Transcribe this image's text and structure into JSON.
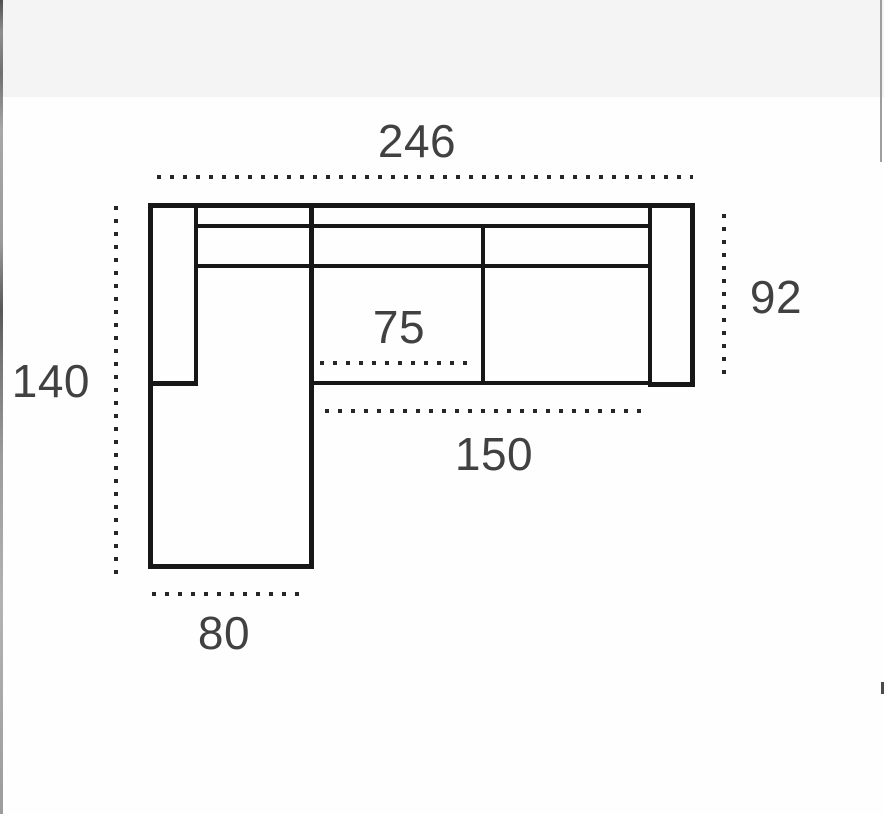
{
  "diagram": {
    "figure": "corner-sofa-top-view-plan",
    "line_color": "#171717",
    "label_color": "#414141",
    "dimensions": {
      "total_width": "246",
      "left_depth": "140",
      "body_depth": "92",
      "middle_seat_width": "75",
      "seat_span_width": "150",
      "chaise_width": "80"
    }
  }
}
